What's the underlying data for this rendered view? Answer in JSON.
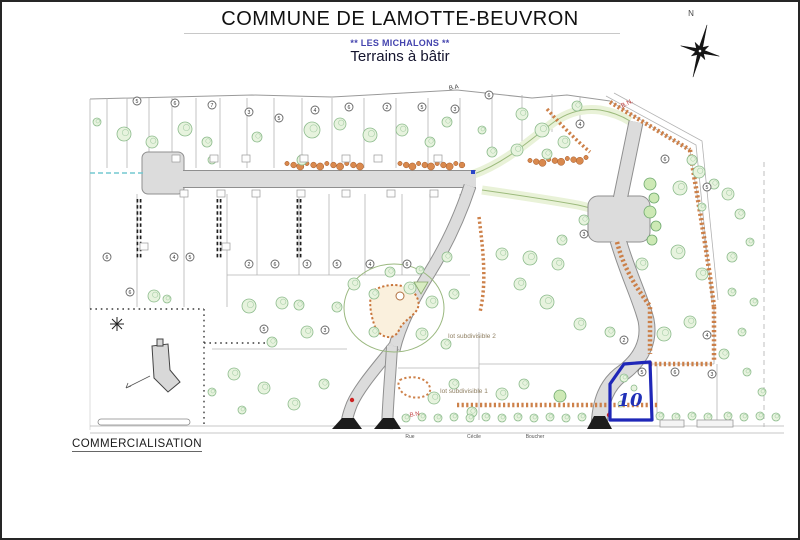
{
  "header": {
    "title": "COMMUNE DE LAMOTTE-BEUVRON",
    "subtitle1": "** LES MICHALONS **",
    "subtitle2": "Terrains à bâtir"
  },
  "footer": {
    "commercialisation": "COMMERCIALISATION"
  },
  "colors": {
    "highlight_blue": "#1f27b8",
    "hedge_orange": "#c9763b",
    "road_gray": "#dcdcdc",
    "tree_green": "#8cbb8c",
    "label_red": "#c03a3a"
  },
  "map": {
    "site_paths": [
      {
        "d": "M88,97 L250,93 L330,95 L455,88 L530,96 L565,93 L608,99",
        "c": "outline",
        "n": "site-boundary-top"
      },
      {
        "d": "M608,99 L688,148 C696,200 706,255 712,305 L712,360",
        "c": "outline2",
        "n": "site-boundary-ne"
      },
      {
        "d": "M604,94 L694,143 L710,300",
        "c": "bn",
        "n": "bn-road-line"
      },
      {
        "d": "M612,91 L700,139 L716,298",
        "c": "bn",
        "n": "bn-road-line"
      }
    ],
    "parcel_lines": [
      [
        105,
        96,
        105,
        166,
        "s"
      ],
      [
        125,
        96,
        125,
        166,
        "s"
      ],
      [
        147,
        96,
        147,
        166,
        "s"
      ],
      [
        170,
        96,
        170,
        166,
        "s"
      ],
      [
        194,
        96,
        194,
        166,
        "s"
      ],
      [
        218,
        96,
        218,
        166,
        "s"
      ],
      [
        245,
        96,
        245,
        166,
        "s"
      ],
      [
        272,
        96,
        272,
        166,
        "s"
      ],
      [
        300,
        96,
        300,
        166,
        "s"
      ],
      [
        330,
        96,
        330,
        166,
        "s"
      ],
      [
        362,
        96,
        362,
        166,
        "s"
      ],
      [
        394,
        96,
        394,
        166,
        "s"
      ],
      [
        426,
        96,
        426,
        166,
        "s"
      ],
      [
        458,
        96,
        458,
        166,
        "s"
      ],
      [
        490,
        94,
        490,
        148,
        "s"
      ],
      [
        520,
        93,
        520,
        140,
        "s"
      ],
      [
        550,
        92,
        550,
        130,
        "s"
      ],
      [
        578,
        94,
        578,
        122,
        "s"
      ],
      [
        88,
        97,
        88,
        307,
        "s"
      ],
      [
        88,
        307,
        88,
        428,
        "f"
      ],
      [
        135,
        192,
        135,
        305,
        "s"
      ],
      [
        182,
        192,
        182,
        305,
        "s"
      ],
      [
        225,
        192,
        225,
        305,
        "s"
      ],
      [
        255,
        192,
        255,
        273,
        "s"
      ],
      [
        297,
        192,
        297,
        273,
        "s"
      ],
      [
        327,
        192,
        327,
        273,
        "s"
      ],
      [
        363,
        192,
        363,
        273,
        "s"
      ],
      [
        400,
        192,
        400,
        273,
        "s"
      ],
      [
        428,
        192,
        428,
        273,
        "s"
      ],
      [
        458,
        192,
        458,
        205,
        "s"
      ],
      [
        225,
        273,
        468,
        273,
        "s"
      ],
      [
        210,
        347,
        345,
        347,
        "s"
      ],
      [
        396,
        366,
        477,
        366,
        "s"
      ],
      [
        477,
        330,
        477,
        418,
        "s"
      ],
      [
        655,
        362,
        655,
        418,
        "s"
      ],
      [
        712,
        305,
        712,
        362,
        "s"
      ],
      [
        715,
        362,
        715,
        425,
        "s"
      ],
      [
        477,
        362,
        712,
        362,
        "s"
      ],
      [
        88,
        307,
        202,
        307,
        "dot"
      ],
      [
        202,
        307,
        202,
        425,
        "dot"
      ],
      [
        202,
        341,
        270,
        341,
        "dot"
      ],
      [
        137,
        197,
        137,
        258,
        "dd"
      ],
      [
        217,
        197,
        217,
        258,
        "dd"
      ],
      [
        297,
        197,
        297,
        258,
        "dd"
      ],
      [
        762,
        160,
        762,
        425,
        "dash"
      ],
      [
        88,
        424,
        782,
        424,
        "s"
      ],
      [
        88,
        431,
        782,
        431,
        "s"
      ]
    ],
    "green_paths": [
      {
        "d": "M472,172 C505,160 530,136 552,120 C566,110 582,106 598,108 C610,110 620,114 628,119"
      },
      {
        "d": "M480,188 C515,193 548,198 576,203 C594,207 606,211 616,217"
      }
    ],
    "pads": [
      {
        "x": 140,
        "y": 150,
        "w": 42,
        "h": 42,
        "rx": 6
      },
      {
        "x": 586,
        "y": 194,
        "w": 62,
        "h": 46,
        "rx": 10
      }
    ],
    "roads": [
      {
        "d": "M178,177 L474,177",
        "w": 18
      },
      {
        "d": "M634,120 L618,198",
        "w": 15
      },
      {
        "d": "M616,238 C626,272 638,295 644,318 C648,338 640,356 622,370 C604,382 598,400 597,426",
        "w": 17
      },
      {
        "d": "M468,184 C458,214 444,244 428,270 C412,296 398,322 392,348",
        "w": 13
      },
      {
        "d": "M392,344 C378,362 358,384 350,402 C346,412 344,420 344,427",
        "w": 12
      },
      {
        "d": "M390,344 C389,366 386,396 385,427",
        "w": 12
      }
    ],
    "hedges": [
      {
        "d": "M608,100 L688,148",
        "w": 4.5
      },
      {
        "d": "M688,148 C696,200 706,255 712,305",
        "w": 4.5
      },
      {
        "d": "M712,305 L712,360",
        "w": 4.5
      },
      {
        "d": "M648,362 L712,362",
        "w": 4.5
      },
      {
        "d": "M455,403 L655,403",
        "w": 4.5
      },
      {
        "d": "M615,240 C622,268 636,288 648,304 L648,352",
        "w": 4.5
      },
      {
        "d": "M477,215 C481,248 485,280 478,310",
        "w": 3.5
      },
      {
        "d": "M545,107 C560,124 574,138 588,150",
        "w": 3.5
      },
      {
        "d": "M398,378 C410,372 426,376 428,386 C430,394 416,398 406,394 C398,391 394,383 398,378 Z",
        "w": 2
      }
    ],
    "shrub_runs": [
      [
        285,
        163,
        358,
        163
      ],
      [
        398,
        163,
        460,
        163
      ],
      [
        528,
        160,
        584,
        157
      ]
    ],
    "loop": {
      "cx": 392,
      "cy": 306,
      "rx": 50,
      "ry": 44
    },
    "blob": {
      "d": "M372,288 C392,278 412,284 416,298 C420,312 402,316 397,328 C392,340 376,336 372,322 C368,310 366,294 372,288 Z"
    },
    "ring": {
      "cx": 398,
      "cy": 294,
      "r": 4
    },
    "triangle": "412,280 426,280 419,292",
    "trees": [
      [
        122,
        132,
        7
      ],
      [
        150,
        140,
        6
      ],
      [
        183,
        127,
        7
      ],
      [
        205,
        140,
        5
      ],
      [
        255,
        135,
        5
      ],
      [
        310,
        128,
        8
      ],
      [
        338,
        122,
        6
      ],
      [
        368,
        133,
        7
      ],
      [
        400,
        128,
        6
      ],
      [
        428,
        140,
        5
      ],
      [
        300,
        158,
        5
      ],
      [
        210,
        158,
        4
      ],
      [
        95,
        120,
        4
      ],
      [
        445,
        120,
        5
      ],
      [
        480,
        128,
        4
      ],
      [
        520,
        112,
        6
      ],
      [
        540,
        128,
        7
      ],
      [
        562,
        140,
        6
      ],
      [
        575,
        104,
        5
      ],
      [
        490,
        150,
        5
      ],
      [
        515,
        148,
        6
      ],
      [
        545,
        152,
        5
      ],
      [
        648,
        182,
        6,
        1
      ],
      [
        652,
        196,
        5,
        1
      ],
      [
        648,
        210,
        6,
        1
      ],
      [
        654,
        224,
        5,
        1
      ],
      [
        650,
        238,
        5,
        1
      ],
      [
        678,
        186,
        7
      ],
      [
        697,
        170,
        6
      ],
      [
        690,
        158,
        5
      ],
      [
        712,
        182,
        5
      ],
      [
        726,
        192,
        6
      ],
      [
        738,
        212,
        5
      ],
      [
        700,
        205,
        4
      ],
      [
        500,
        252,
        6
      ],
      [
        528,
        256,
        7
      ],
      [
        556,
        262,
        6
      ],
      [
        518,
        282,
        6
      ],
      [
        545,
        300,
        7
      ],
      [
        578,
        322,
        6
      ],
      [
        608,
        330,
        5
      ],
      [
        662,
        332,
        7
      ],
      [
        688,
        320,
        6
      ],
      [
        640,
        262,
        6
      ],
      [
        676,
        250,
        7
      ],
      [
        700,
        272,
        6
      ],
      [
        582,
        218,
        5
      ],
      [
        560,
        238,
        5
      ],
      [
        730,
        255,
        5
      ],
      [
        748,
        240,
        4
      ],
      [
        152,
        294,
        6
      ],
      [
        165,
        297,
        4
      ],
      [
        247,
        304,
        7
      ],
      [
        280,
        301,
        6
      ],
      [
        297,
        303,
        5
      ],
      [
        352,
        282,
        6
      ],
      [
        372,
        292,
        5
      ],
      [
        408,
        286,
        6
      ],
      [
        430,
        300,
        6
      ],
      [
        452,
        292,
        5
      ],
      [
        420,
        332,
        6
      ],
      [
        444,
        342,
        5
      ],
      [
        372,
        330,
        5
      ],
      [
        305,
        330,
        6
      ],
      [
        270,
        340,
        5
      ],
      [
        335,
        305,
        5
      ],
      [
        388,
        270,
        5
      ],
      [
        418,
        268,
        4
      ],
      [
        445,
        255,
        5
      ],
      [
        232,
        372,
        6
      ],
      [
        262,
        386,
        6
      ],
      [
        292,
        402,
        6
      ],
      [
        322,
        382,
        5
      ],
      [
        432,
        396,
        6
      ],
      [
        452,
        382,
        5
      ],
      [
        500,
        392,
        6
      ],
      [
        522,
        382,
        5
      ],
      [
        558,
        394,
        6,
        1
      ],
      [
        470,
        410,
        5
      ],
      [
        240,
        408,
        4
      ],
      [
        210,
        390,
        4
      ],
      [
        622,
        376,
        4
      ],
      [
        632,
        386,
        3
      ],
      [
        619,
        402,
        3
      ],
      [
        404,
        416,
        4
      ],
      [
        420,
        415,
        4
      ],
      [
        436,
        416,
        4
      ],
      [
        452,
        415,
        4
      ],
      [
        468,
        416,
        4
      ],
      [
        484,
        415,
        4
      ],
      [
        500,
        416,
        4
      ],
      [
        516,
        415,
        4
      ],
      [
        532,
        416,
        4
      ],
      [
        548,
        415,
        4
      ],
      [
        564,
        416,
        4
      ],
      [
        580,
        415,
        4
      ],
      [
        658,
        414,
        4
      ],
      [
        674,
        415,
        4
      ],
      [
        690,
        414,
        4
      ],
      [
        706,
        415,
        4
      ],
      [
        726,
        414,
        4
      ],
      [
        742,
        415,
        4
      ],
      [
        758,
        414,
        4
      ],
      [
        774,
        415,
        4
      ],
      [
        722,
        352,
        5
      ],
      [
        740,
        330,
        4
      ],
      [
        752,
        300,
        4
      ],
      [
        745,
        370,
        4
      ],
      [
        760,
        390,
        4
      ],
      [
        730,
        290,
        4
      ]
    ],
    "tags": [
      [
        135,
        99,
        "5"
      ],
      [
        173,
        101,
        "6"
      ],
      [
        210,
        103,
        "7"
      ],
      [
        247,
        110,
        "3"
      ],
      [
        277,
        116,
        "5"
      ],
      [
        313,
        108,
        "4"
      ],
      [
        347,
        105,
        "6"
      ],
      [
        385,
        105,
        "2"
      ],
      [
        420,
        105,
        "5"
      ],
      [
        453,
        107,
        "3"
      ],
      [
        487,
        93,
        "6"
      ],
      [
        578,
        122,
        "4"
      ],
      [
        663,
        157,
        "6"
      ],
      [
        705,
        185,
        "5"
      ],
      [
        582,
        232,
        "3"
      ],
      [
        105,
        255,
        "6"
      ],
      [
        172,
        255,
        "4"
      ],
      [
        188,
        255,
        "5"
      ],
      [
        247,
        262,
        "2"
      ],
      [
        273,
        262,
        "6"
      ],
      [
        305,
        262,
        "3"
      ],
      [
        335,
        262,
        "5"
      ],
      [
        368,
        262,
        "4"
      ],
      [
        405,
        262,
        "6"
      ],
      [
        262,
        327,
        "5"
      ],
      [
        323,
        328,
        "3"
      ],
      [
        128,
        290,
        "6"
      ],
      [
        705,
        333,
        "4"
      ],
      [
        640,
        370,
        "5"
      ],
      [
        673,
        370,
        "6"
      ],
      [
        710,
        372,
        "3"
      ],
      [
        622,
        338,
        "2"
      ]
    ],
    "features": [
      {
        "d": "M150,344 L166,342 L168,368 L178,380 L166,390 L152,376 Z",
        "c": "bld",
        "n": "building-footprint"
      },
      {
        "d": "M115,315 L115,329 M108,322 L122,322 M110,317 L120,327 M110,327 L120,317",
        "c": "star",
        "n": "survey-mark"
      },
      {
        "d": "M124,386 L148,374 M124,386 L129,384 M124,386 L126,381",
        "c": "thin",
        "n": "dimension-arrow"
      },
      {
        "d": "M88,171 L141,171",
        "c": "stream",
        "n": "ditch-line"
      },
      {
        "d": "M330,427 L340,416 L352,416 L360,427 Z",
        "c": "flare",
        "n": "road-entrance"
      },
      {
        "d": "M372,427 L381,416 L392,416 L399,427 Z",
        "c": "flare",
        "n": "road-entrance"
      },
      {
        "d": "M585,427 L592,414 L603,414 L610,427 Z",
        "c": "flare",
        "n": "road-entrance"
      }
    ],
    "rects": [
      {
        "x": 155,
        "y": 337,
        "w": 6,
        "h": 7,
        "c": "bld",
        "n": "building-annex"
      },
      {
        "x": 96,
        "y": 417,
        "w": 92,
        "h": 6,
        "rx": 3,
        "c": "ditch",
        "n": "ditch-strip"
      },
      {
        "x": 658,
        "y": 418,
        "w": 24,
        "h": 7,
        "c": "drv",
        "n": "driveway"
      },
      {
        "x": 695,
        "y": 418,
        "w": 36,
        "h": 7,
        "c": "drv",
        "n": "driveway"
      },
      {
        "x": 469,
        "y": 168,
        "w": 4,
        "h": 4,
        "c": "bluemk",
        "n": "blue-marker"
      }
    ],
    "markers": [
      [
        170,
        153
      ],
      [
        208,
        153
      ],
      [
        240,
        153
      ],
      [
        298,
        153
      ],
      [
        340,
        153
      ],
      [
        372,
        153
      ],
      [
        432,
        153
      ],
      [
        178,
        188
      ],
      [
        215,
        188
      ],
      [
        250,
        188
      ],
      [
        295,
        188
      ],
      [
        340,
        188
      ],
      [
        385,
        188
      ],
      [
        428,
        188
      ],
      [
        138,
        241
      ],
      [
        220,
        241
      ]
    ],
    "red_dots": [
      [
        350,
        398
      ],
      [
        607,
        413
      ]
    ],
    "lot10": {
      "d": "M608,418 L608,382 L622,362 L648,360 L650,418 Z",
      "label": "10",
      "lx": 628,
      "ly": 404
    },
    "labels": [
      {
        "t": "B.A",
        "x": 452,
        "y": 87,
        "r": -10,
        "fs": 6,
        "c": "dark"
      },
      {
        "t": "B.N.",
        "x": 626,
        "y": 103,
        "r": -28,
        "fs": 6.5,
        "c": "red"
      },
      {
        "t": "B.N",
        "x": 413,
        "y": 414,
        "r": -10,
        "fs": 6,
        "c": "red"
      },
      {
        "t": "lot subdivisible 2",
        "x": 470,
        "y": 336,
        "r": 0,
        "fs": 6.5,
        "c": "tan"
      },
      {
        "t": "lot subdivisible 1",
        "x": 462,
        "y": 391,
        "r": 0,
        "fs": 6.5,
        "c": "tan"
      }
    ],
    "street_words": [
      {
        "t": "Rue",
        "x": 408,
        "y": 436
      },
      {
        "t": "Cécile",
        "x": 472,
        "y": 436
      },
      {
        "t": "Boucher",
        "x": 533,
        "y": 436
      }
    ],
    "compass": {
      "cx": 698,
      "cy": 49,
      "rot": 15,
      "arms": [
        27,
        10,
        20,
        10,
        27,
        10,
        20,
        10
      ],
      "inner": 4.5,
      "label": "N",
      "lx": 689,
      "ly": 14
    }
  }
}
